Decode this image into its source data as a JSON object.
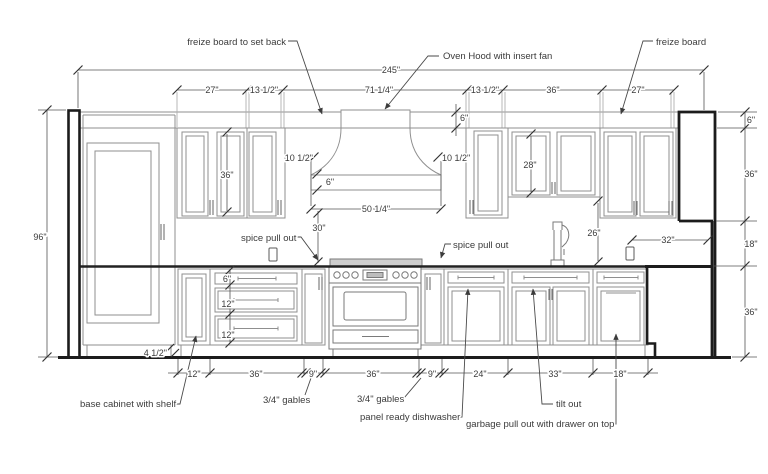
{
  "drawing": {
    "title": "kitchen cabinet elevation",
    "dims": {
      "total_width": "245\"",
      "upper_row": [
        "27\"",
        "13 1/2\"",
        "71 1/4\"",
        "13 1/2\"",
        "36\"",
        "27\""
      ],
      "height": "96\"",
      "freize_height_top": "6\"",
      "hood_left_drop": "10 1/2\"",
      "hood_right_drop": "10 1/2\"",
      "hood_band_height": "6\"",
      "hood_width": "50 1/4\"",
      "hood_to_counter": "30\"",
      "upper_door_height_left": "36\"",
      "upper_door_height_right": "28\"",
      "counter_to_upper": "26\"",
      "right_opening_width": "32\"",
      "right_stack": [
        "6\"",
        "36\"",
        "18\"",
        "36\""
      ],
      "drawer_heights": [
        "6\"",
        "12\"",
        "12\""
      ],
      "base_row": [
        "12\"",
        "36\"",
        "9\"",
        "36\"",
        "9\"",
        "24\"",
        "33\"",
        "18\""
      ],
      "toe_kick": "4 1/2\""
    },
    "callouts": {
      "freize_setback": "freize board to set back",
      "oven_hood": "Oven Hood with insert fan",
      "freize_board": "freize board",
      "spice_left": "spice pull out",
      "spice_right": "spice pull out",
      "base_shelf": "base cabinet with shelf",
      "gables_left": "3/4\" gables",
      "gables_right": "3/4\" gables",
      "dishwasher": "panel ready dishwasher",
      "tilt_out": "tilt out",
      "garbage": "garbage pull out with drawer on top"
    },
    "colors": {
      "wall": "#1c1c1c",
      "cabinet_line": "#8f8f8f",
      "dim_line": "#555555",
      "text": "#3b3b3b",
      "background": "#ffffff"
    }
  }
}
